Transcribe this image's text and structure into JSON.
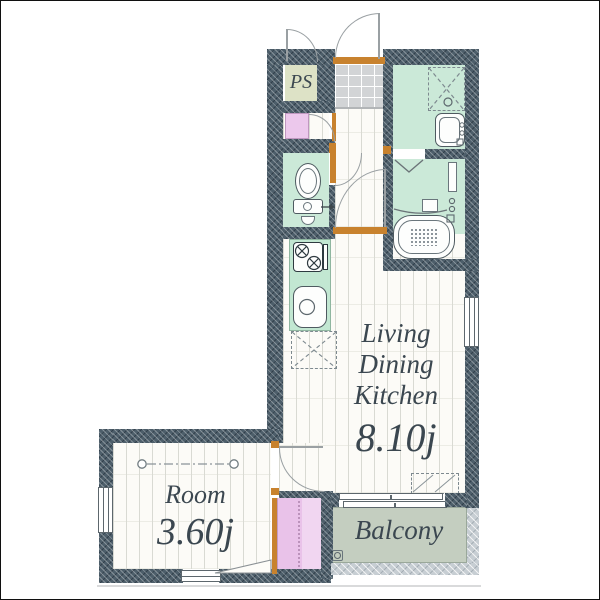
{
  "floorplan": {
    "labels": {
      "ldk_line1": "Living",
      "ldk_line2": "Dining",
      "ldk_line3": "Kitchen",
      "ldk_size": "8.10j",
      "room_label": "Room",
      "room_size": "3.60j",
      "balcony_label": "Balcony",
      "pipe_space_label": "PS"
    },
    "colors": {
      "wall": "#4d5e6a",
      "wet_area_floor": "#cbe9d8",
      "wood_floor": "#fcfbf7",
      "entrance_tile": "#d2d4d6",
      "closet": "#e9c2e9",
      "pipe_space": "#dde2c6",
      "balcony": "#c4cec0",
      "balcony_wall": "#c7ced3",
      "door_accent": "#c8822e",
      "label_text": "#3b4750"
    },
    "fixtures": [
      "entrance-door",
      "pipe-space-door",
      "shoe-storage",
      "toilet",
      "washbasin",
      "washing-machine-space",
      "bathtub",
      "bath-folding-door",
      "kitchen-stove",
      "kitchen-sink",
      "refrigerator-space",
      "air-conditioner-space",
      "ceiling-light",
      "sliding-window",
      "balcony-drain",
      "window"
    ]
  }
}
